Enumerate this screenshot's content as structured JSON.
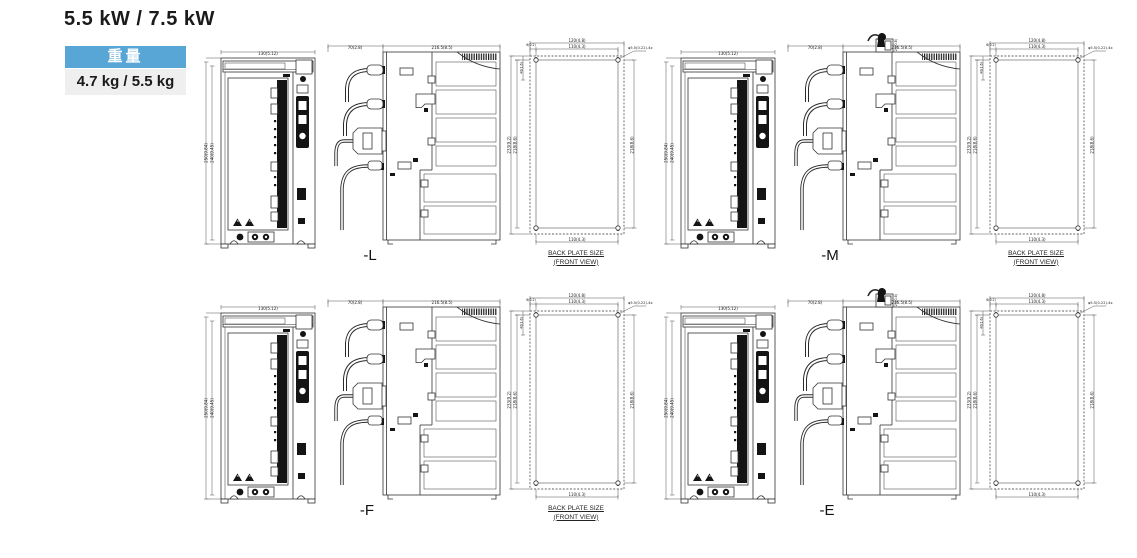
{
  "page": {
    "title": "5.5 kW / 7.5 kW"
  },
  "weight_badge": {
    "header": "重量",
    "value": "4.7 kg / 5.5 kg",
    "header_bg": "#58A6D6",
    "header_color": "#FFFFFF",
    "value_bg": "#EFEFEF"
  },
  "groups": [
    {
      "label": "-L",
      "variant": "cables-front",
      "back_plate_caption": true
    },
    {
      "label": "-M",
      "variant": "cables-top-connector",
      "back_plate_caption": true
    },
    {
      "label": "-F",
      "variant": "cables-front",
      "back_plate_caption": true
    },
    {
      "label": "-E",
      "variant": "cables-top-connector",
      "back_plate_caption": false
    }
  ],
  "back_plate_caption": {
    "line1": "BACK PLATE SIZE",
    "line2": "(FRONT VIEW)"
  },
  "dims": {
    "front_width": "130(5.12)",
    "front_height_outer": "250(9.84)",
    "front_height_inner": "240(9.45)",
    "side_front": "70(2.8)",
    "side_body": "216.5(8.5)",
    "side_top_small": "20(0.8)",
    "bp_width": "120(4.8)",
    "bp_pitch_w": "110(4.3)",
    "bp_top_small": "6(0.2)",
    "bp_left_small": "40(1.6)",
    "bp_height": "233(9.2)",
    "bp_pitch_h": "218(8.6)",
    "bp_pitch_h_r": "218(8.6)",
    "bp_bottom": "110(4.3)",
    "bp_hole": "φ5.5(0.22)-4x"
  }
}
